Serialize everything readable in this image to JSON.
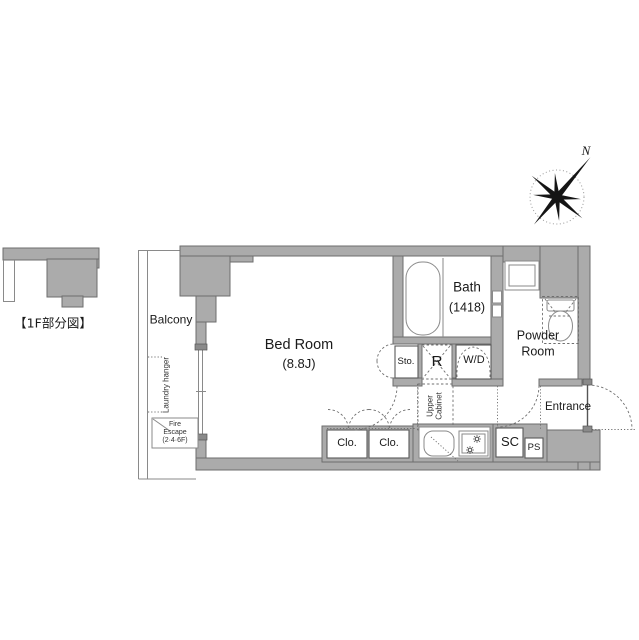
{
  "overview": {
    "label": "【1F部分図】"
  },
  "compass": {
    "north": "N"
  },
  "rooms": {
    "balcony": {
      "label": "Balcony"
    },
    "bedroom": {
      "name": "Bed Room",
      "size": "(8.8J)"
    },
    "bath": {
      "name": "Bath",
      "size": "(1418)"
    },
    "powder_room": {
      "name_line1": "Powder",
      "name_line2": "Room"
    },
    "entrance": {
      "label": "Entrance"
    }
  },
  "fixtures": {
    "laundry_hanger": {
      "label": "Laundry hanger"
    },
    "fire_escape": {
      "line1": "Fire",
      "line2": "Escape",
      "line3": "(2·4·6F)"
    },
    "storage": {
      "label": "Sto."
    },
    "refrigerator": {
      "label": "R"
    },
    "washer_dryer": {
      "label": "W/D"
    },
    "upper_cabinet": {
      "line1": "Upper",
      "line2": "Cabinet"
    },
    "closet_left": {
      "label": "Clo."
    },
    "closet_right": {
      "label": "Clo."
    },
    "shoe_cabinet": {
      "label": "SC"
    },
    "pipe_space": {
      "label": "PS"
    }
  },
  "colors": {
    "wall_fill": "#ababab",
    "wall_outline": "#6e6e6e",
    "line": "#6f6f6f"
  }
}
